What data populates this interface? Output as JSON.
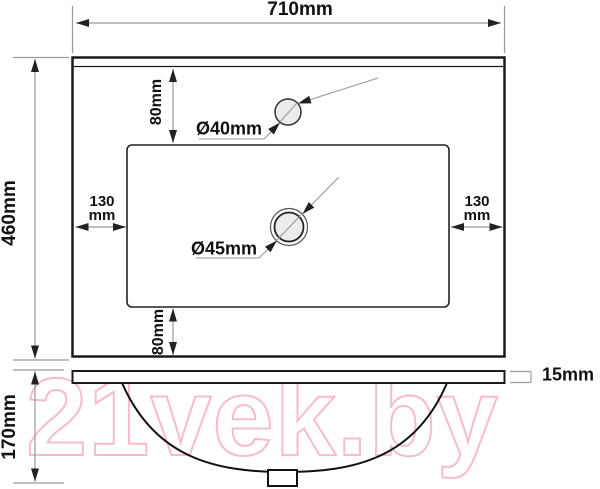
{
  "diagram": {
    "labels": {
      "width": "710mm",
      "depth": "460mm",
      "height": "170mm",
      "thickness": "15mm",
      "offset_top": "80mm",
      "offset_bottom": "80mm",
      "offset_left_value": "130",
      "offset_left_unit": "mm",
      "offset_right_value": "130",
      "offset_right_unit": "mm",
      "faucet_hole_diameter": "Ø40mm",
      "drain_hole_diameter": "Ø45mm"
    },
    "colors": {
      "outline": "#1a1a1a",
      "dimension_lines": "#999999",
      "arrowheads": "#222222",
      "hole_fill": "#ececec",
      "watermark_pink": "#f7bcc9"
    }
  },
  "watermark": {
    "text": "21vek.by"
  }
}
